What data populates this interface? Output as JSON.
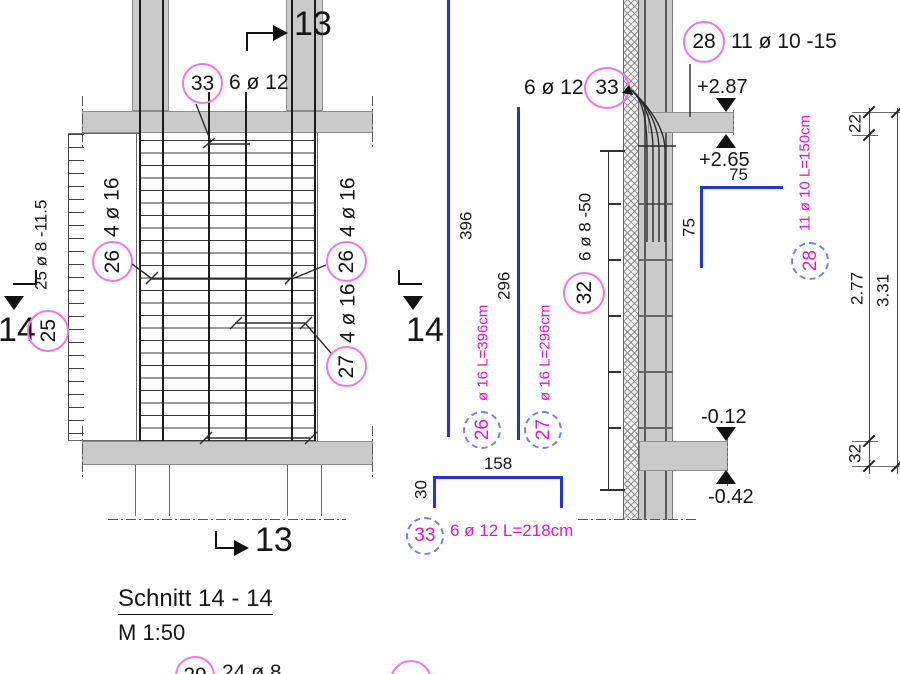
{
  "title": {
    "heading": "Schnitt 14 - 14",
    "scale": "M 1:50"
  },
  "plan": {
    "marker_13_top": "13",
    "marker_13_bottom": "13",
    "marker_14_left": "14",
    "marker_14_right": "14",
    "callout_33": {
      "num": "33",
      "label": "6 ø 12"
    },
    "callout_25": {
      "num": "25",
      "label": "25 ø 8 -11.5"
    },
    "callout_26_left": {
      "num": "26",
      "label": "4 ø 16"
    },
    "callout_26_right": {
      "num": "26",
      "label": "4 ø 16"
    },
    "callout_27": {
      "num": "27",
      "label": "4 ø 16"
    }
  },
  "shapes": {
    "dim_396": "396",
    "dim_296": "296",
    "bar_26": {
      "num": "26",
      "label": "ø 16 L=396cm"
    },
    "bar_27": {
      "num": "27",
      "label": "ø 16 L=296cm"
    },
    "staple": {
      "num": "33",
      "label": "6 ø 12 L=218cm",
      "dim_width": "158",
      "dim_leg": "30"
    }
  },
  "section": {
    "callout_28": {
      "num": "28",
      "label": "11 ø 10 -15"
    },
    "callout_33": {
      "num": "33",
      "label": "6 ø 12"
    },
    "callout_32": {
      "num": "32",
      "label": "6 ø 8 -50"
    },
    "bar_28": {
      "num": "28",
      "label": "11 ø 10 L=150cm",
      "dim_top": "75",
      "dim_side": "75"
    },
    "levels": {
      "l287": "+2.87",
      "l265": "+2.65",
      "l012": "-0.12",
      "l042": "-0.42"
    },
    "dims": {
      "d22": "22",
      "d277": "2.77",
      "d32": "32",
      "d331": "3.31"
    }
  },
  "partial_bottom": {
    "num": "29",
    "label": "24 ø 8"
  }
}
